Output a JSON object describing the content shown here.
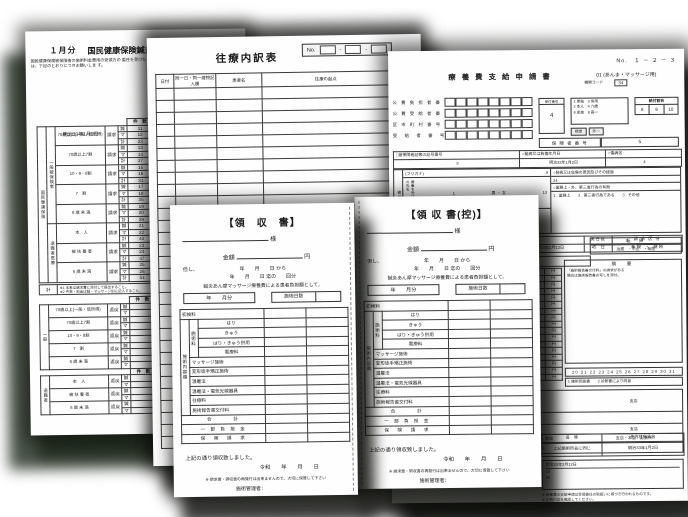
{
  "kokuho": {
    "month_label": "１月分",
    "title": "国民健康保険鍼灸マッサージ療養費請求総括票",
    "intro_lines": [
      "国民健康保険被保険者の施術料金費用の受領方の",
      "委任を受けたるのは、下記のとおりにつきお願いしま",
      "す。"
    ],
    "info_labels": [
      "登録記号番号",
      "施術所の所在地",
      "所在地名称",
      "施術管理者",
      "保険者番号"
    ],
    "insurer_no_value": "1",
    "date": "明治33年1月2日",
    "col_count": "件　数",
    "col_fee": "施術料金",
    "outer_label": "国民健康保険",
    "mode_claim": "請求",
    "mode_return": "返戻",
    "kinds": [
      "鍼",
      "マ",
      "計"
    ],
    "claim_sections": [
      {
        "label": "一般被保険者",
        "rows": [
          {
            "name": "70歳以上(一般・低所得)",
            "cells": [
              [
                "11",
                "27"
              ],
              [
                "12",
                "28"
              ],
              [
                "23",
                "55"
              ]
            ]
          },
          {
            "name": "70歳以上7割",
            "cells": [
              [
                "13",
                "29"
              ],
              [
                "14",
                "30"
              ],
              [
                "27",
                "59"
              ]
            ]
          },
          {
            "name": "10・9・8割",
            "cells": [
              [
                "15",
                "31"
              ],
              [
                "16",
                "32"
              ],
              [
                "31",
                "63"
              ]
            ]
          },
          {
            "name": "7　割",
            "cells": [
              [
                "17",
                "33"
              ],
              [
                "18",
                "34"
              ],
              [
                "35",
                "67"
              ]
            ]
          },
          {
            "name": "6 歳 未 満",
            "cells": [
              [
                "19",
                "35"
              ],
              [
                "20",
                "36"
              ],
              [
                "39",
                "71"
              ]
            ]
          }
        ]
      },
      {
        "label": "退職者医療",
        "rows": [
          {
            "name": "本　人",
            "cells": [
              [
                "21",
                "37"
              ],
              [
                "22",
                "38"
              ],
              [
                "43",
                "75"
              ]
            ]
          },
          {
            "name": "被 扶 養 者",
            "cells": [
              [
                "23",
                "39"
              ],
              [
                "24",
                "40"
              ],
              [
                "47",
                "79"
              ]
            ]
          },
          {
            "name": "6 歳 未 満",
            "cells": [
              [
                "25",
                "41"
              ],
              [
                "26",
                "42"
              ],
              [
                "51",
                "83"
              ]
            ]
          }
        ]
      }
    ],
    "note_box_label": "計",
    "note_lines": [
      "※1 本表は請求書に添付して提出すること。",
      "※2 件数・料金は鍼・マッサージ別に記入すること。"
    ],
    "henrei_sections": [
      {
        "label": "一般",
        "rows": [
          "70歳以上(一般・低所得)",
          "70歳以上7割",
          "10・9・8割",
          "7　割",
          "6 歳 未 満"
        ]
      },
      {
        "label": "退職者",
        "rows": [
          "本　人",
          "被 扶 養 者",
          "6 歳 未 満"
        ]
      }
    ]
  },
  "oryo": {
    "title": "往療内訳表",
    "no_label": "No.",
    "dash": "-",
    "headers": [
      "日付",
      "同一日・同一建物記入欄",
      "患者名",
      "往療の起点"
    ],
    "empty_rows": 30
  },
  "shinsei": {
    "page_no": "No.　１ － ２ － ３",
    "title": "療 養 費 支 給 申 請 書",
    "title_code": "01",
    "title_use": "(あんま・マッサージ用)",
    "org_code_label": "機関コード",
    "org_code": "34",
    "code_rows": [
      "公 費 負 担 者 番 号",
      "公 費 受 給 者 番 号",
      "区 市 町 村 番 号",
      "受　給　者　番　号"
    ],
    "recv_label": "受付番号",
    "recv_value": "4",
    "legend_lines": [
      "1 単独　3 併用",
      "2 本人　4 六歳",
      "6 家族　8 高一"
    ],
    "ratio_label": "給付割合",
    "ratio_values": [
      "8",
      "9",
      "10"
    ],
    "small_cells": [
      "視覚",
      "外一"
    ],
    "insurer_label": "保 険 者 番 号",
    "insurer_value": "5",
    "rec_headers": [
      "□被保険者証等の記号番号",
      "○発病又は負傷年月日",
      "○傷病名"
    ],
    "rec_values": [
      "9",
      "明治33年1月2日",
      "4"
    ],
    "side_label": "被保険者欄",
    "furigana": "(フリガナ)",
    "furigana_val": "9",
    "name_label": "療養を受けた者の氏名",
    "name_val": "1",
    "sex": "男 ・ 女",
    "num13": "13",
    "era_line": "明・大・昭・平・令　6  7  8  9  10  11  12  13",
    "cause_header": "○発病又は負傷の原因及びその経過",
    "cause_val": "24",
    "work_header": "○業務上・外、第三者行為の有無",
    "work_options": "1 . 業務上　　2 . 第三者行為である　　3 . その他",
    "term_headers": [
      "初療年月日",
      "施　術　期　間",
      "実日数",
      "請 求 区 分"
    ],
    "term_first": "明治33年1月2日",
    "term_period": "自　明治33年2月1日　〜至　明治33年2月12日",
    "term_days": "45　日",
    "term_category": "新 規　・　継 続",
    "symptom_label": "傷病名又は症状",
    "symptom_val": "21",
    "outcome_label": "転　帰",
    "outcome_values": "治癒　・中止　・転医",
    "memo_label": "摘　要",
    "memo_lines": [
      "「施術報告書交付料」の請求がある",
      "場合は施術報告書の写しを添付。"
    ],
    "fee_side_label": "マッサージ",
    "fee_x_label": "回×",
    "fee_eq_label": "回=",
    "yen": "円",
    "fee_rows": [
      {
        "part": "躯　幹",
        "unit": "61",
        "count": "46",
        "amount": "2,806"
      },
      {
        "part": "右上肢",
        "unit": "61",
        "count": "47",
        "amount": "2,847"
      },
      {
        "part": "左上肢",
        "unit": "61",
        "count": "48",
        "amount": "2,929"
      },
      {
        "part": "右下肢",
        "unit": "61",
        "count": "49",
        "amount": "2,969"
      },
      {
        "part": "左下肢",
        "unit": "61",
        "count": "50",
        "amount": "3,050"
      },
      {
        "amount": "3,152"
      },
      {
        "amount": "3,176"
      },
      {
        "amount": "3,282"
      },
      {
        "amount": "3,356"
      },
      {
        "amount": "3,520"
      },
      {
        "amount": "3,584"
      },
      {
        "amount": "3,745"
      },
      {
        "amount": "3,829"
      },
      {
        "amount": "3,953"
      },
      {
        "amount": "3,508"
      },
      {
        "amount": ""
      },
      {
        "amount": ""
      }
    ],
    "dates_row": "20 21 22 23 24 25 26 27 28 29 30 31",
    "agree_line": "1 施術同意書　　2 診断書により同意",
    "pay_rows": [
      {
        "num": "32",
        "a": "銀行",
        "b": "支店"
      },
      {
        "num": "30",
        "a": "",
        "b": ""
      },
      {
        "num": "21",
        "a": "銀行",
        "b": "支店"
      },
      {
        "num": "",
        "a": "銀行・金庫・農協",
        "b": "支店・本店・出張所"
      },
      {
        "num": "36",
        "a": "普通預金",
        "b": ""
      }
    ],
    "addr_headers": [
      "名　称",
      "先方住所氏名"
    ],
    "addr_values": [
      "上記施術所名に同じ",
      "明治33年1月2日"
    ],
    "bottom_lines": [
      "明治33年2月12日",
      "23",
      "26"
    ],
    "foot_notes": [
      "※ 療養費の支給申請は受領委任の取扱いに基づき行われるものです。",
      "※ 記載内容を確認してください。",
      "※ 振込の場合は、施術管理者の口座とする。"
    ]
  },
  "receipt": {
    "title_left": "【領　収　書】",
    "title_right": "【領 収 書(控)】",
    "name_suffix": "様",
    "amount_label": "金額",
    "yen": "円",
    "proviso": "但し、",
    "from_line": "年　　月　　日 から",
    "to_line": "年　　月　　日 迄の　　回分",
    "desc": "鍼灸あん摩マッサージ療養費による患者負担額として。",
    "month_box": "年　　月分",
    "days_box": "施術日数",
    "side_label": "施術内容欄",
    "group_label": "施術料",
    "row_single": "初検料",
    "group_rows": [
      "はり",
      "きゅう",
      "はり・きゅう併用",
      "電療料"
    ],
    "normal_rows": [
      "マッサージ施術",
      "変形徒手矯正施術",
      "温罨法",
      "温罨法・電気光線器具",
      "往療料",
      "施術報告書交付料"
    ],
    "total_rows": [
      "合　　　計",
      "一 部 負 担 金",
      "保　険　請　求"
    ],
    "received_line": "上記の通り領収致しました。",
    "era_date": "令和　　年　　月　　日",
    "note": "※ 請求書・領収書の再発行は出来ませんので、大切に保管して下さい",
    "manager": "施術管理者："
  }
}
